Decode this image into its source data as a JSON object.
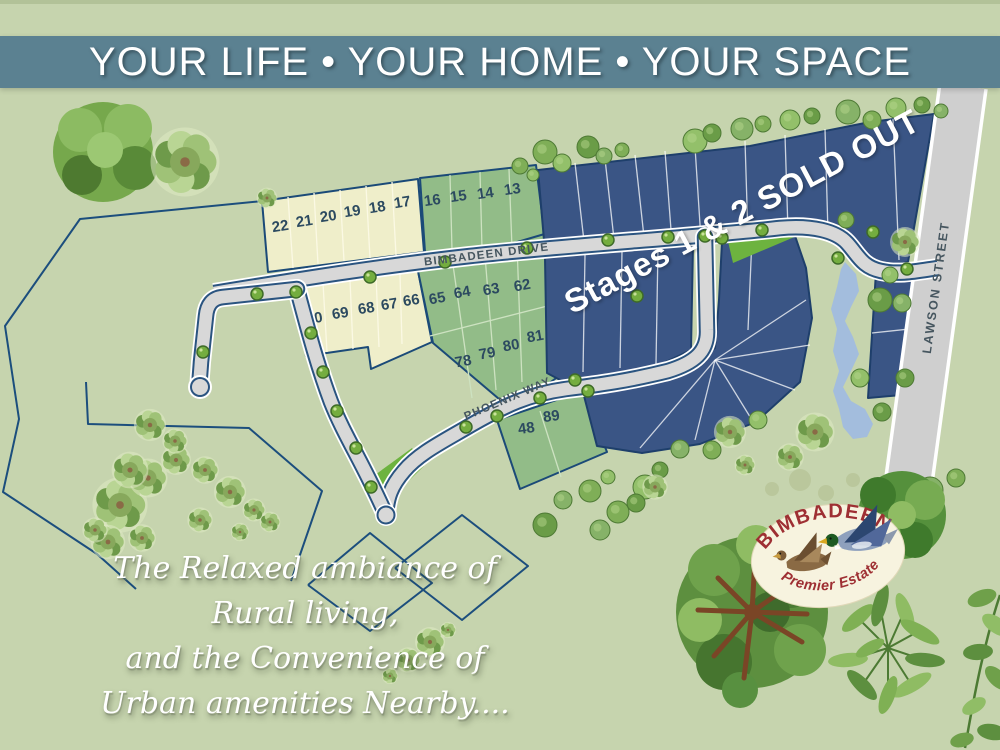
{
  "banner": {
    "text": "YOUR LIFE • YOUR HOME • YOUR SPACE",
    "bg": "#5b8191",
    "fg": "#ffffff"
  },
  "sold_out": {
    "text": "Stages 1 & 2 SOLD OUT",
    "color": "#ffffff"
  },
  "tagline": {
    "lines": [
      "The Relaxed ambiance of",
      "Rural living,",
      "and the Convenience of",
      "Urban amenities Nearby...."
    ],
    "color": "#ffffff"
  },
  "logo": {
    "title": "BIMBADEEN",
    "subtitle": "Premier Estate",
    "text_color": "#9e2f33",
    "bg": "#f7f3df"
  },
  "map": {
    "bg": "#c6d4ae",
    "boundary_color": "#1c4e7d",
    "water_color": "#a3bddd",
    "green_patch_color": "#6db33f",
    "lot_number_color": "#2c4a60",
    "street_label_color": "#46565f",
    "road_fill": "#d8d8d8",
    "road_edge": "#2a5480",
    "navy_fill": "#3a5585",
    "cream_fill": "#efeeca",
    "green_fill": "#92bc88",
    "boundaries": [
      "263,201 80,219 5,326 19,419 3,492 97,554 136,589",
      "86,382 88,424 249,428 322,491 291,581",
      "308,585 370,533 432,583 370,631 308,585",
      "395,568 462,515 528,566 462,620 395,568"
    ],
    "pond_points": "845,262 856,274 859,291 851,307 845,321 853,337 859,354 851,371 843,387 851,401 865,409 873,424 867,437 853,439 843,427 839,409 833,391 839,371 833,351 837,329 831,309 837,287 841,269",
    "patches": [
      "727,237 818,227 733,263",
      "368,480 412,448 424,466 388,501"
    ],
    "lot_groups": [
      {
        "id": "lots-cream-north",
        "fill": "#efeeca",
        "stroke": "#1b4a78",
        "divider": "#fbf9e4",
        "num_rot": -9,
        "points": "262,201 418,179 424,252 268,272",
        "dividers": [
          [
            288,
            197,
            293,
            268
          ],
          [
            314,
            193,
            318,
            264
          ],
          [
            340,
            190,
            344,
            261
          ],
          [
            366,
            186,
            370,
            258
          ],
          [
            392,
            182,
            396,
            255
          ]
        ],
        "lots": [
          {
            "n": "22",
            "x": 281,
            "y": 231
          },
          {
            "n": "21",
            "x": 305,
            "y": 226
          },
          {
            "n": "20",
            "x": 329,
            "y": 221
          },
          {
            "n": "19",
            "x": 353,
            "y": 216
          },
          {
            "n": "18",
            "x": 378,
            "y": 212
          },
          {
            "n": "17",
            "x": 403,
            "y": 207
          }
        ]
      },
      {
        "id": "lots-green-north",
        "fill": "#92bc88",
        "stroke": "#1b4a78",
        "divider": "#cde2c1",
        "num_rot": -8,
        "points": "420,178 536,165 546,247 425,252",
        "dividers": [
          [
            450,
            175,
            452,
            250
          ],
          [
            480,
            172,
            482,
            249
          ],
          [
            509,
            169,
            512,
            248
          ]
        ],
        "lots": [
          {
            "n": "16",
            "x": 433,
            "y": 205
          },
          {
            "n": "15",
            "x": 459,
            "y": 201
          },
          {
            "n": "14",
            "x": 486,
            "y": 198
          },
          {
            "n": "13",
            "x": 513,
            "y": 194
          }
        ]
      },
      {
        "id": "lots-cream-mid",
        "fill": "#efeeca",
        "stroke": "#1b4a78",
        "divider": "#fbf9e4",
        "num_rot": -9,
        "points": "297,287 418,271 432,342 371,369 368,347 306,356",
        "dividers": [
          [
            323,
            283,
            327,
            352
          ],
          [
            350,
            280,
            353,
            349
          ],
          [
            376,
            276,
            379,
            347
          ],
          [
            400,
            274,
            402,
            344
          ]
        ],
        "lots": [
          {
            "n": "70",
            "x": 315,
            "y": 323
          },
          {
            "n": "69",
            "x": 341,
            "y": 318
          },
          {
            "n": "68",
            "x": 367,
            "y": 313
          },
          {
            "n": "67",
            "x": 390,
            "y": 309
          },
          {
            "n": "66",
            "x": 412,
            "y": 305
          }
        ]
      },
      {
        "id": "lots-green-mid",
        "fill": "#92bc88",
        "stroke": "#1b4a78",
        "divider": "#cde2c1",
        "num_rot": -10,
        "points": "418,271 548,233 566,371 512,410 433,343",
        "dividers": [
          [
            453,
            265,
            472,
            398
          ],
          [
            485,
            256,
            496,
            390
          ],
          [
            517,
            245,
            522,
            382
          ],
          [
            430,
            336,
            563,
            302
          ]
        ],
        "lots": [
          {
            "n": "65",
            "x": 438,
            "y": 303
          },
          {
            "n": "64",
            "x": 463,
            "y": 297
          },
          {
            "n": "63",
            "x": 492,
            "y": 294
          },
          {
            "n": "62",
            "x": 523,
            "y": 290
          },
          {
            "n": "78",
            "x": 464,
            "y": 366
          },
          {
            "n": "79",
            "x": 488,
            "y": 358
          },
          {
            "n": "80",
            "x": 512,
            "y": 350
          },
          {
            "n": "81",
            "x": 536,
            "y": 341
          }
        ]
      },
      {
        "id": "lots-green-south",
        "fill": "#92bc88",
        "stroke": "#1b4a78",
        "divider": "#cde2c1",
        "num_rot": -8,
        "points": "497,420 583,391 607,452 520,489",
        "dividers": [
          [
            540,
            411,
            561,
            477
          ]
        ],
        "lots": [
          {
            "n": "48",
            "x": 527,
            "y": 433
          },
          {
            "n": "89",
            "x": 552,
            "y": 421
          }
        ]
      },
      {
        "id": "lots-navy-top",
        "fill": "#3a5585",
        "stroke": "#1e3f6b",
        "divider": "rgba(255,255,255,0.75)",
        "points": "538,170 750,146 870,122 934,114 908,262 880,268 862,262 850,246 832,234 800,229 700,240 545,252",
        "dividers": [
          [
            575,
            163,
            585,
            250
          ],
          [
            605,
            159,
            615,
            248
          ],
          [
            635,
            155,
            645,
            246
          ],
          [
            665,
            151,
            672,
            243
          ],
          [
            695,
            147,
            701,
            240
          ],
          [
            745,
            141,
            748,
            237
          ],
          [
            785,
            135,
            788,
            231
          ],
          [
            825,
            129,
            828,
            233
          ],
          [
            893,
            119,
            899,
            260
          ]
        ],
        "lots": []
      },
      {
        "id": "lots-navy-left",
        "fill": "#3a5585",
        "stroke": "#1e3f6b",
        "divider": "rgba(255,255,255,0.75)",
        "points": "545,258 693,245 691,350 655,367 562,381 547,373",
        "dividers": [
          [
            585,
            255,
            583,
            372
          ],
          [
            622,
            251,
            620,
            368
          ],
          [
            658,
            248,
            656,
            364
          ]
        ],
        "lots": []
      },
      {
        "id": "lots-navy-fan",
        "fill": "#3a5585",
        "stroke": "#1e3f6b",
        "divider": "rgba(255,255,255,0.75)",
        "points": "722,242 794,233 806,268 812,318 800,382 756,422 700,444 642,453 597,446 583,392 660,377 697,362 715,348 719,300",
        "dividers": [
          [
            752,
            238,
            748,
            330
          ],
          [
            715,
            360,
            806,
            300
          ],
          [
            715,
            360,
            810,
            345
          ],
          [
            715,
            360,
            795,
            390
          ],
          [
            715,
            360,
            752,
            420
          ],
          [
            715,
            360,
            695,
            440
          ],
          [
            715,
            360,
            640,
            448
          ]
        ],
        "lots": []
      },
      {
        "id": "lots-navy-lawson",
        "fill": "#3a5585",
        "stroke": "#1e3f6b",
        "divider": "rgba(255,255,255,0.75)",
        "points": "876,272 933,264 924,393 868,398",
        "dividers": [
          [
            872,
            333,
            928,
            327
          ]
        ],
        "lots": []
      }
    ],
    "streets": [
      {
        "id": "bimbadeen-drive",
        "name": "BIMBADEEN DRIVE",
        "x": 487,
        "y": 258,
        "rotate": -7,
        "size": 11.5,
        "spacing": 1.2
      },
      {
        "id": "phoenix-way",
        "name": "PHOENIX WAY",
        "x": 509,
        "y": 402,
        "rotate": -23,
        "size": 11.5,
        "spacing": 1.2
      },
      {
        "id": "lawson-street",
        "name": "LAWSON STREET",
        "x": 940,
        "y": 288,
        "rotate": -82,
        "size": 12.5,
        "spacing": 2
      }
    ],
    "trees": {
      "dots": [
        [
          296,
          292
        ],
        [
          257,
          294
        ],
        [
          203,
          352
        ],
        [
          311,
          333
        ],
        [
          323,
          372
        ],
        [
          337,
          411
        ],
        [
          356,
          448
        ],
        [
          371,
          487
        ],
        [
          445,
          262
        ],
        [
          370,
          277
        ],
        [
          527,
          248
        ],
        [
          608,
          240
        ],
        [
          668,
          237
        ],
        [
          705,
          236
        ],
        [
          762,
          230
        ],
        [
          838,
          258
        ],
        [
          873,
          232
        ],
        [
          907,
          269
        ],
        [
          466,
          427
        ],
        [
          497,
          416
        ],
        [
          540,
          398
        ],
        [
          575,
          380
        ],
        [
          588,
          391
        ],
        [
          637,
          296
        ],
        [
          722,
          238
        ]
      ],
      "rounds": [
        [
          545,
          152,
          12
        ],
        [
          562,
          163,
          9
        ],
        [
          588,
          147,
          11
        ],
        [
          604,
          156,
          8
        ],
        [
          622,
          150,
          7
        ],
        [
          695,
          141,
          12
        ],
        [
          712,
          133,
          9
        ],
        [
          742,
          129,
          11
        ],
        [
          763,
          124,
          8
        ],
        [
          790,
          120,
          10
        ],
        [
          812,
          116,
          8
        ],
        [
          848,
          112,
          12
        ],
        [
          872,
          120,
          9
        ],
        [
          896,
          108,
          10
        ],
        [
          922,
          105,
          8
        ],
        [
          941,
          111,
          7
        ],
        [
          520,
          166,
          8
        ],
        [
          533,
          175,
          6
        ],
        [
          880,
          300,
          12
        ],
        [
          902,
          303,
          9
        ],
        [
          846,
          220,
          8
        ],
        [
          890,
          275,
          8
        ],
        [
          882,
          412,
          9
        ],
        [
          600,
          530,
          10
        ],
        [
          618,
          512,
          11
        ],
        [
          645,
          487,
          12
        ],
        [
          660,
          470,
          8
        ],
        [
          680,
          449,
          9
        ],
        [
          712,
          450,
          9
        ],
        [
          758,
          420,
          9
        ],
        [
          545,
          525,
          12
        ],
        [
          563,
          500,
          9
        ],
        [
          590,
          491,
          11
        ],
        [
          608,
          477,
          7
        ],
        [
          636,
          503,
          9
        ],
        [
          930,
          490,
          13
        ],
        [
          956,
          478,
          9
        ],
        [
          860,
          378,
          9
        ],
        [
          905,
          378,
          9
        ]
      ],
      "flowers": [
        [
          267,
          198,
          9
        ],
        [
          185,
          162,
          30
        ],
        [
          120,
          505,
          24
        ],
        [
          148,
          478,
          17
        ],
        [
          176,
          460,
          13
        ],
        [
          108,
          542,
          15
        ],
        [
          142,
          538,
          12
        ],
        [
          200,
          520,
          11
        ],
        [
          230,
          492,
          14
        ],
        [
          254,
          510,
          10
        ],
        [
          150,
          425,
          14
        ],
        [
          175,
          441,
          11
        ],
        [
          130,
          470,
          16
        ],
        [
          205,
          470,
          12
        ],
        [
          270,
          522,
          9
        ],
        [
          240,
          532,
          8
        ],
        [
          95,
          530,
          11
        ],
        [
          815,
          432,
          17
        ],
        [
          790,
          457,
          12
        ],
        [
          745,
          465,
          9
        ],
        [
          655,
          487,
          11
        ],
        [
          430,
          642,
          13
        ],
        [
          408,
          660,
          11
        ],
        [
          390,
          676,
          7
        ],
        [
          448,
          630,
          7
        ],
        [
          905,
          242,
          13
        ],
        [
          730,
          432,
          14
        ]
      ],
      "sage": [
        [
          800,
          480,
          11
        ],
        [
          826,
          493,
          8
        ],
        [
          853,
          480,
          7
        ],
        [
          772,
          489,
          7
        ]
      ]
    }
  }
}
